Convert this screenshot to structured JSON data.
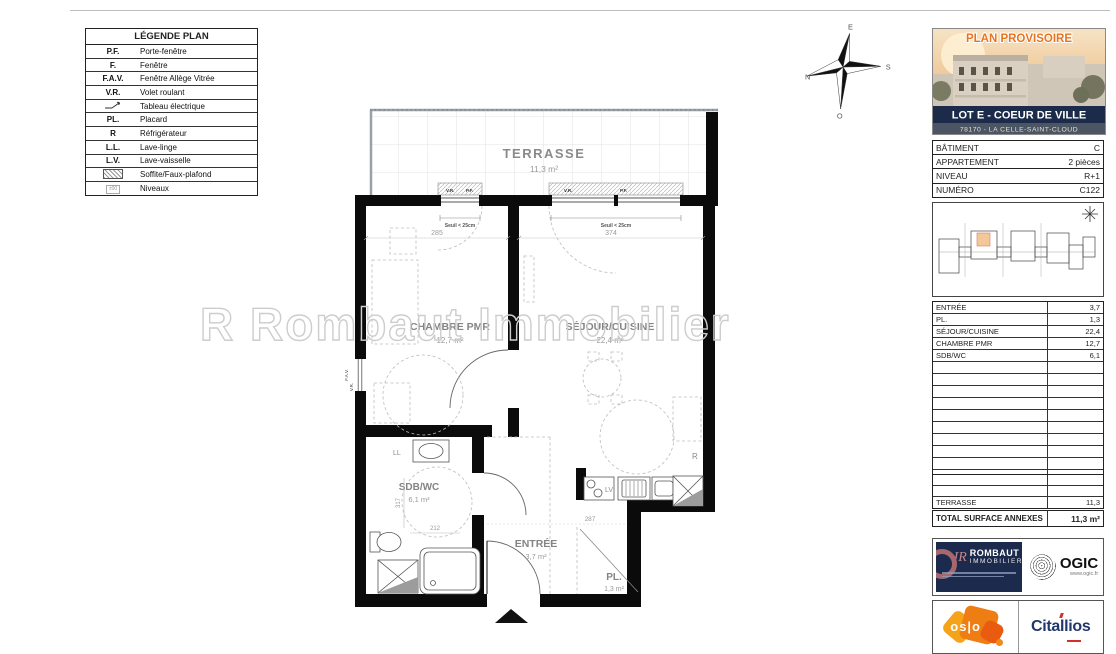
{
  "legend": {
    "title": "LÉGENDE PLAN",
    "items": [
      {
        "abbr": "P.F.",
        "label": "Porte-fenêtre"
      },
      {
        "abbr": "F.",
        "label": "Fenêtre"
      },
      {
        "abbr": "F.A.V.",
        "label": "Fenêtre Allège Vitrée"
      },
      {
        "abbr": "V.R.",
        "label": "Volet roulant"
      },
      {
        "abbr": "",
        "label": "Tableau électrique",
        "icon": "electric-symbol"
      },
      {
        "abbr": "PL.",
        "label": "Placard"
      },
      {
        "abbr": "R",
        "label": "Réfrigérateur"
      },
      {
        "abbr": "L.L.",
        "label": "Lave-linge"
      },
      {
        "abbr": "L.V.",
        "label": "Lave-vaisselle"
      },
      {
        "abbr": "",
        "label": "Soffite/Faux-plafond",
        "icon": "hatch-swatch"
      },
      {
        "abbr": "",
        "label": "Niveaux",
        "icon": "level-chip",
        "chip": "±00"
      }
    ]
  },
  "compass": {
    "top": "E",
    "right": "S",
    "bottom": "O",
    "left": "N"
  },
  "plan": {
    "watermark": "R Rombaut Immobilier",
    "terrace": {
      "name": "TERRASSE",
      "area": "11,3 m²"
    },
    "rooms": {
      "chambre": {
        "name": "CHAMBRE PMR",
        "area": "12,7 m²"
      },
      "sejour": {
        "name": "SÉJOUR/CUISINE",
        "area": "22,4 m²"
      },
      "sdb": {
        "name": "SDB/WC",
        "area": "6,1 m²"
      },
      "entree": {
        "name": "ENTRÉE",
        "area": "3,7 m²"
      },
      "placard": {
        "name": "PL.",
        "area": "1,3 m²"
      }
    },
    "labels": {
      "vr": "V.R.",
      "pf": "P.F.",
      "fav": "F.A.V.",
      "seuil": "Seuil < 25cm",
      "ll": "LL",
      "lv": "LV",
      "r": "R"
    },
    "dims": {
      "d285": "285",
      "d374": "374",
      "d317": "317",
      "d212": "212",
      "d287": "287"
    }
  },
  "panel": {
    "provisional": "PLAN PROVISOIRE",
    "lot_title": "LOT E - COEUR DE VILLE",
    "lot_subtitle": "78170 - LA CELLE-SAINT-CLOUD",
    "info": [
      {
        "label": "BÂTIMENT",
        "value": "C"
      },
      {
        "label": "APPARTEMENT",
        "value": "2 pièces"
      },
      {
        "label": "NIVEAU",
        "value": "R+1"
      },
      {
        "label": "NUMÉRO",
        "value": "C122"
      }
    ],
    "areas": [
      {
        "label": "ENTRÉE",
        "value": "3,7"
      },
      {
        "label": "PL.",
        "value": "1,3"
      },
      {
        "label": "SÉJOUR/CUISINE",
        "value": "22,4"
      },
      {
        "label": "CHAMBRE PMR",
        "value": "12,7"
      },
      {
        "label": "SDB/WC",
        "value": "6,1"
      }
    ],
    "totals": {
      "habitable": {
        "label": "TOTAL SURFACE HABITABLE",
        "value": "46,2 m²"
      },
      "terrasse": {
        "label": "TERRASSE",
        "value": "11,3"
      },
      "annexes": {
        "label": "TOTAL SURFACE ANNEXES",
        "value": "11,3 m²"
      }
    },
    "logos": {
      "rombaut": {
        "monogram": "JR",
        "line1": "ROMBAUT",
        "line2": "IMMOBILIER"
      },
      "ogic": {
        "name": "OGIC",
        "url": "www.ogic.fr"
      },
      "oslo": {
        "name": "os|o"
      },
      "citallios": {
        "name": "Citallios"
      }
    }
  },
  "colors": {
    "accent_orange": "#e8731e",
    "navy": "#1c2b4d",
    "wall_black": "#0b0b0b",
    "label_gray": "#8a8a8a",
    "highlight_unit": "#f4c79b",
    "citallios_blue": "#22376b",
    "citallios_red": "#d2302c"
  }
}
